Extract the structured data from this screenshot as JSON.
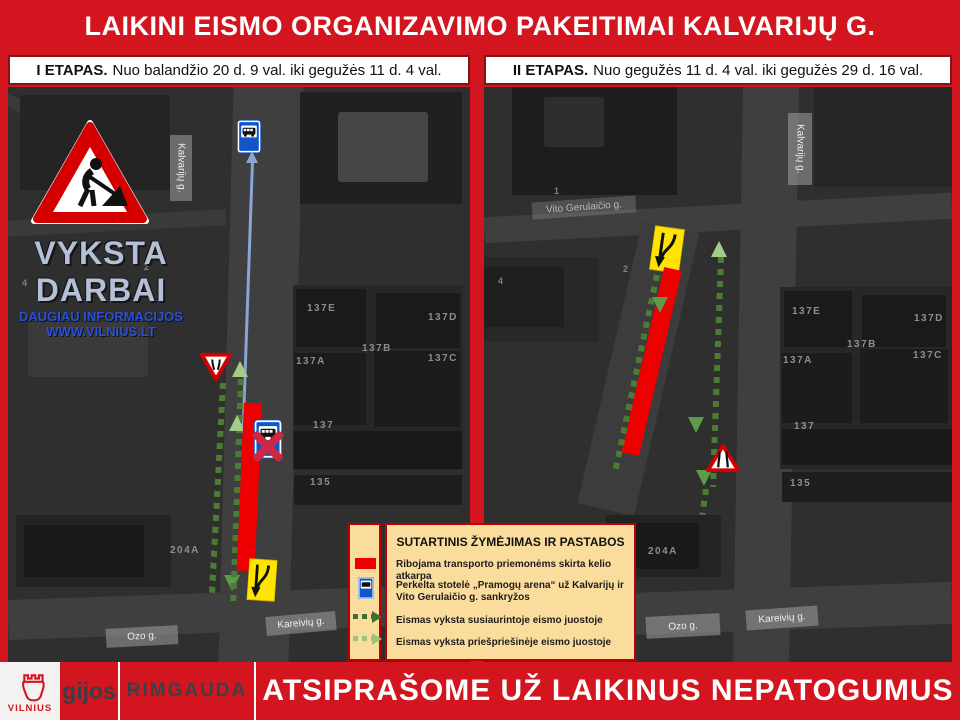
{
  "header": {
    "title": "LAIKINI EISMO ORGANIZAVIMO PAKEITIMAI KALVARIJŲ G."
  },
  "stages": [
    {
      "name": "I ETAPAS.",
      "period": "Nuo balandžio 20 d. 9 val. iki gegužės 11 d. 4 val."
    },
    {
      "name": "II ETAPAS.",
      "period": "Nuo gegužės 11 d. 4 val. iki gegužės 29 d. 16 val."
    }
  ],
  "notice": {
    "line1": "VYKSTA",
    "line2": "DARBAI",
    "info1": "DAUGIAU INFORMACIJOS",
    "info2": "WWW.VILNIUS.LT"
  },
  "streets": {
    "kalvariju": "Kalvarijų g.",
    "ozo": "Ozo g.",
    "kareiviu": "Kareivių g.",
    "gerulaicio": "Vito Gerulaičio g."
  },
  "buildings": [
    "137E",
    "137D",
    "137B",
    "137A",
    "137C",
    "137",
    "135",
    "204A"
  ],
  "plot_numbers": [
    "1",
    "2",
    "4"
  ],
  "legend": {
    "title": "SUTARTINIS ŽYMĖJIMAS IR PASTABOS",
    "items": [
      {
        "symbol": "closed-road-bar",
        "text": "Ribojama transporto priemonėms skirta kelio atkarpa"
      },
      {
        "symbol": "bus-stop-sign",
        "text": "Perkelta stotelė „Pramogų arena“ už Kalvarijų ir Vito Gerulaičio g. sankryžos"
      },
      {
        "symbol": "dark-green-dashed-arrow",
        "text": "Eismas vyksta susiaurintoje eismo juostoje"
      },
      {
        "symbol": "light-green-dashed-arrow",
        "text": "Eismas vyksta priešpriešinėje eismo juostoje"
      }
    ]
  },
  "footer": {
    "city_logo": "VILNIUS",
    "partner1": "gijos",
    "partner2": "RIMGAUDA",
    "message": "ATSIPRAŠOME UŽ LAIKINUS NEPATOGUMUS"
  },
  "colors": {
    "brand_red": "#d2151e",
    "closed_lane_red": "#ee0000",
    "contraflow_dark_green": "#4c7c34",
    "contraflow_light_green": "#a6cc8a",
    "legend_bg": "#fadc9c",
    "sign_yellow": "#ffe400",
    "bus_sign_blue": "#1056c8"
  }
}
